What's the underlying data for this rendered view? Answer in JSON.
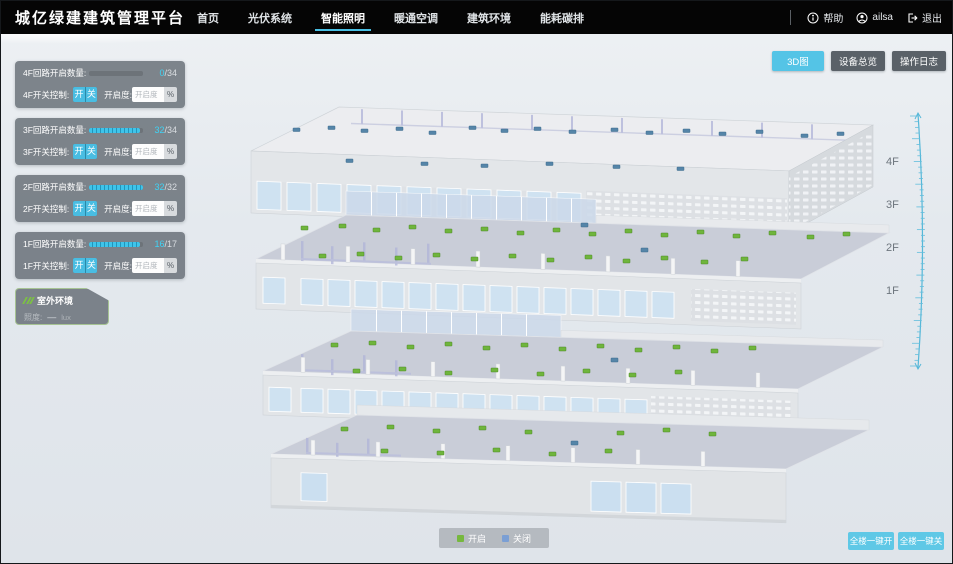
{
  "header": {
    "title": "城亿绿建建筑管理平台",
    "nav": [
      {
        "label": "首页"
      },
      {
        "label": "光伏系统"
      },
      {
        "label": "智能照明"
      },
      {
        "label": "暖通空调"
      },
      {
        "label": "建筑环境"
      },
      {
        "label": "能耗碳排"
      }
    ],
    "help_label": "帮助",
    "user_name": "ailsa",
    "logout_label": "退出"
  },
  "view_buttons": {
    "map3d": "3D图",
    "device_overview": "设备总览",
    "operation_log": "操作日志"
  },
  "floors": [
    {
      "circuit_label": "4F回路开启数量:",
      "on_count": "0",
      "total_suffix": "/34",
      "progress_pct": 0,
      "switch_label": "4F开关控制:",
      "on_label": "开",
      "off_label": "关",
      "openness_label": "开启度:",
      "openness_placeholder": "开启度",
      "percent_label": "%"
    },
    {
      "circuit_label": "3F回路开启数量:",
      "on_count": "32",
      "total_suffix": "/34",
      "progress_pct": 94,
      "switch_label": "3F开关控制:",
      "on_label": "开",
      "off_label": "关",
      "openness_label": "开启度:",
      "openness_placeholder": "开启度",
      "percent_label": "%"
    },
    {
      "circuit_label": "2F回路开启数量:",
      "on_count": "32",
      "total_suffix": "/32",
      "progress_pct": 100,
      "switch_label": "2F开关控制:",
      "on_label": "开",
      "off_label": "关",
      "openness_label": "开启度:",
      "openness_placeholder": "开启度",
      "percent_label": "%"
    },
    {
      "circuit_label": "1F回路开启数量:",
      "on_count": "16",
      "total_suffix": "/17",
      "progress_pct": 94,
      "switch_label": "1F开关控制:",
      "on_label": "开",
      "off_label": "关",
      "openness_label": "开启度:",
      "openness_placeholder": "开启度",
      "percent_label": "%"
    }
  ],
  "outdoor": {
    "title": "室外环境",
    "illuminance_label": "照度:",
    "illuminance_value": "—",
    "illuminance_unit": "lux"
  },
  "floor_axis": [
    "4F",
    "3F",
    "2F",
    "1F"
  ],
  "legend": {
    "on_label": "开启",
    "on_color": "#76b83e",
    "off_label": "关闭",
    "off_color": "#7b9fd4"
  },
  "bottom_buttons": {
    "all_on": "全楼一键开",
    "all_off": "全楼一键关"
  },
  "colors": {
    "accent": "#54c4e6",
    "header_bg": "#050505",
    "panel_bg": "rgba(86,94,102,0.74)"
  }
}
